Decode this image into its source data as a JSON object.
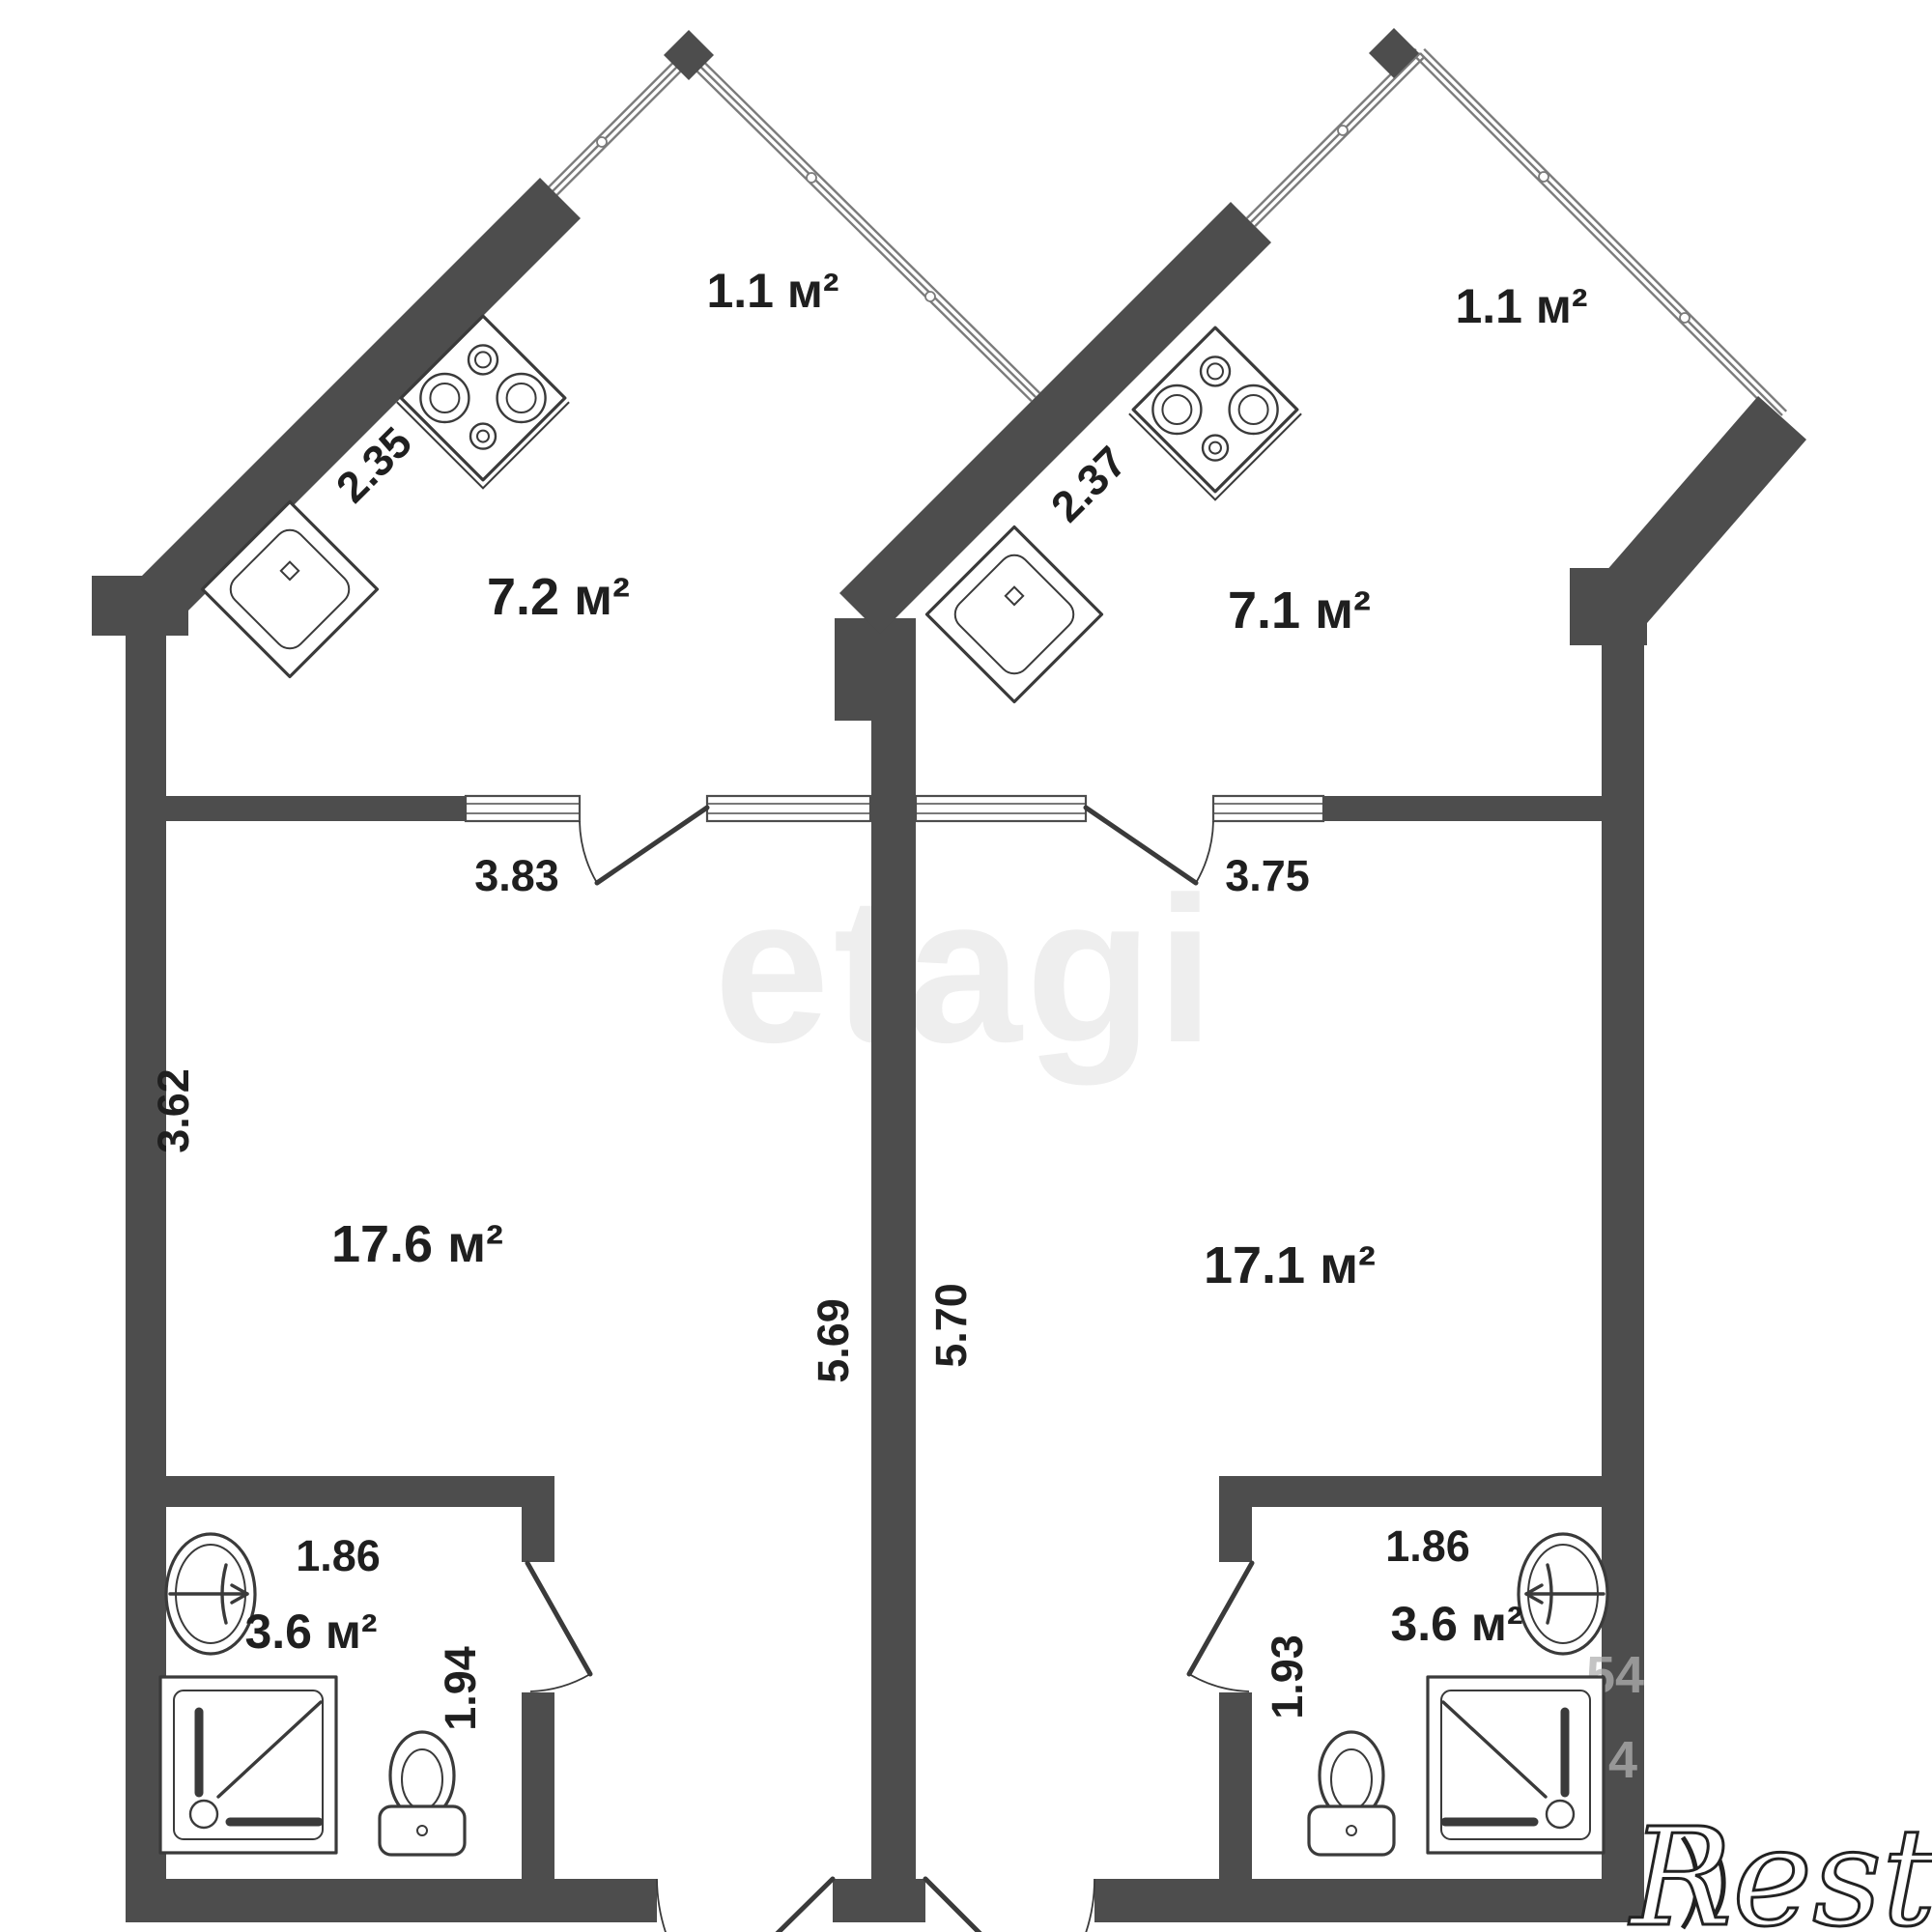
{
  "watermarks": {
    "center": "etagi",
    "corner": "Restate",
    "digits_a": "54",
    "digits_b": "4"
  },
  "apartments": {
    "left": {
      "balcony_area": "1.1 м²",
      "kitchen_area": "7.2 м²",
      "living_area": "17.6 м²",
      "bathroom_area": "3.6 м²",
      "kitchen_counter": "2.35",
      "kitchen_width": "3.83",
      "living_width": "3.62",
      "living_depth": "5.69",
      "bathroom_width": "1.86",
      "bathroom_depth": "1.94"
    },
    "right": {
      "balcony_area": "1.1 м²",
      "kitchen_area": "7.1 м²",
      "living_area": "17.1 м²",
      "bathroom_area": "3.6 м²",
      "kitchen_counter": "2.37",
      "kitchen_width": "3.75",
      "living_depth": "5.70",
      "bathroom_width": "1.86",
      "bathroom_depth": "1.93"
    }
  },
  "colors": {
    "wall": "#4d4d4d",
    "line": "#3a3a3a",
    "glazing": "#7b7b7b",
    "text": "#1f1f1f",
    "bg": "#fcfcfc"
  }
}
